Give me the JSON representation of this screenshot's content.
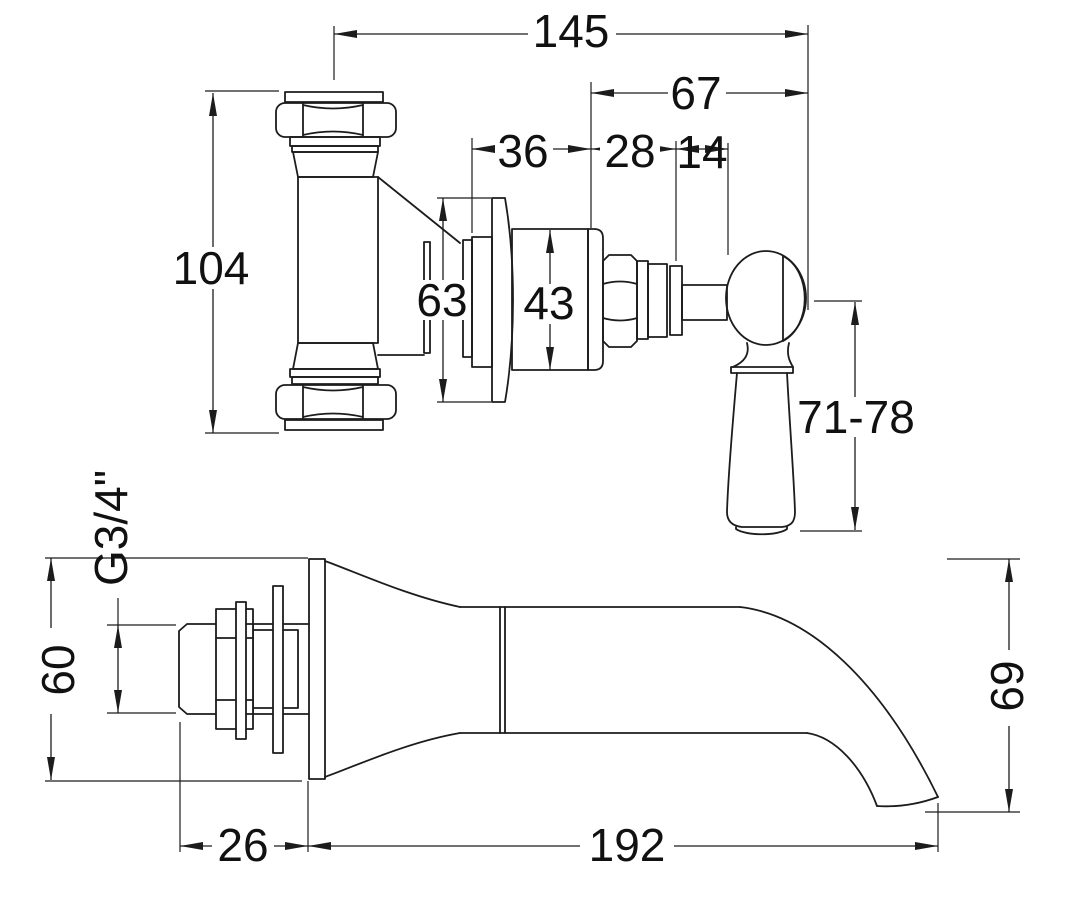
{
  "colors": {
    "ink": "#1c1c1c",
    "background": "#ffffff",
    "text": "#111111"
  },
  "drawing": {
    "type": "technical-dimension-drawing",
    "subject": "wall-mounted valve and bath spout, two orthographic views",
    "valve_view": {
      "width_overall": "145",
      "handle_projection": "67",
      "trim_depth": "36",
      "bonnet_length": "28",
      "stem_length": "14",
      "body_height": "104",
      "flange_diameter": "63",
      "cartridge_diameter": "43",
      "handle_length": "71-78"
    },
    "spout_view": {
      "inlet_height": "60",
      "thread_size": "G3/4\"",
      "tail_length": "26",
      "spout_projection": "192",
      "spout_drop": "69"
    }
  }
}
